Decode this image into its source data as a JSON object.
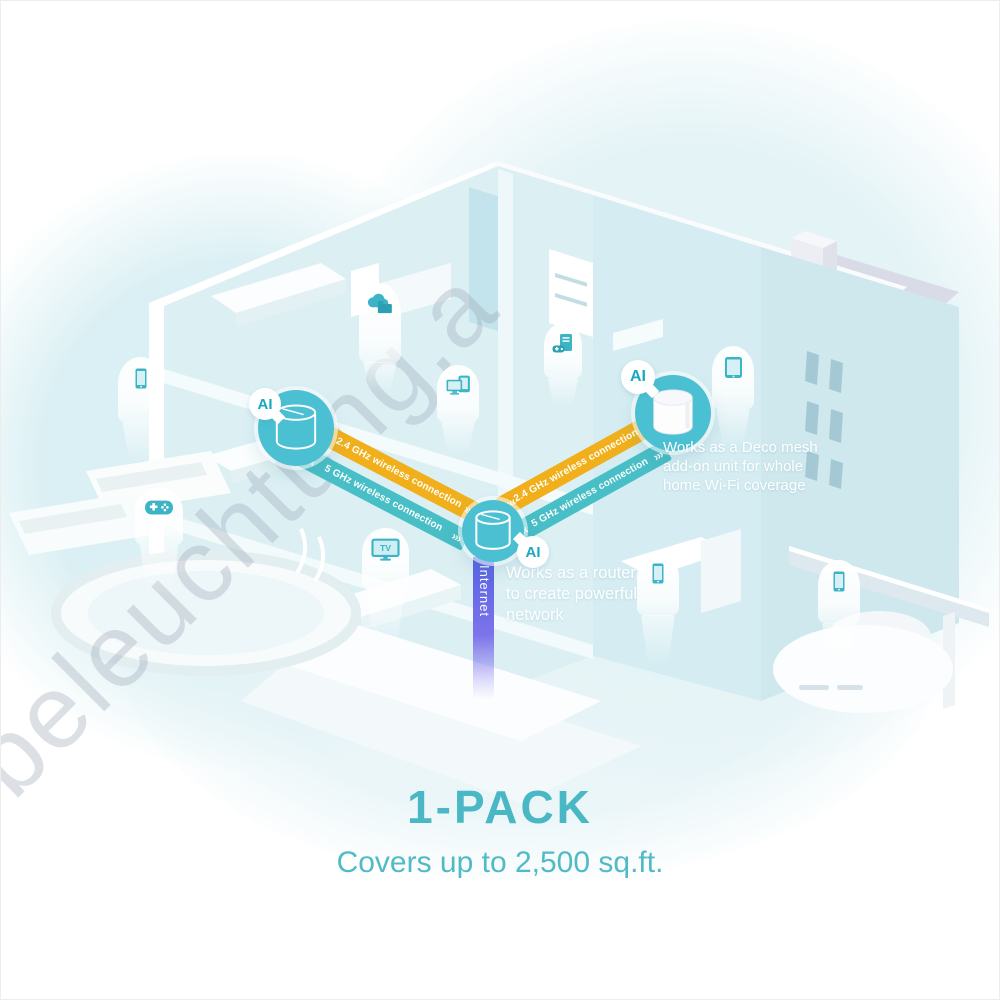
{
  "hero": {
    "pack_title": "1-PACK",
    "coverage_subtitle": "Covers up to 2,500 sq.ft."
  },
  "watermark": "beleuchtung.a",
  "network": {
    "ai_label": "AI",
    "internet_label": "Internet",
    "band_24ghz_label": "2.4 GHz wireless connection",
    "band_5ghz_label": "5 GHz wireless connection",
    "chevrons_back": "‹‹‹",
    "chevrons_forward": "›››",
    "router_note": [
      "Works as a router",
      "to create powerful",
      "network"
    ],
    "addon_note": [
      "Works as a Deco mesh",
      "add-on unit for whole",
      "home Wi-Fi coverage"
    ]
  },
  "devices": {
    "tv_label": "TV",
    "badges": [
      "smartphone",
      "game-controller",
      "cloud-storage",
      "multi-device",
      "gaming-pc",
      "smart-tv",
      "tablet",
      "smartphone",
      "smartphone"
    ]
  },
  "colors": {
    "accent_teal": "#49b7c4",
    "band_orange": "#f1b01b",
    "band_teal": "#48bec6",
    "node_teal": "#4bc0d2",
    "internet_blue": "#5663e3"
  }
}
